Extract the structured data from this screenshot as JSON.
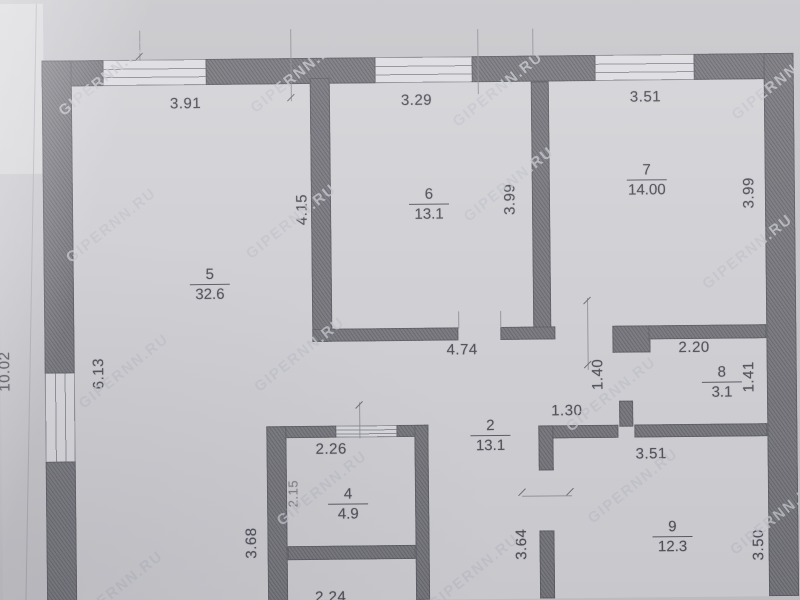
{
  "document": {
    "kind": "scanned floor plan (BTI style)"
  },
  "watermark": {
    "text": "GIPERNN.RU"
  },
  "rooms": {
    "r5": {
      "number": "5",
      "area": "32.6"
    },
    "r6": {
      "number": "6",
      "area": "13.1"
    },
    "r7": {
      "number": "7",
      "area": "14.00"
    },
    "r2": {
      "number": "2",
      "area": "13.1"
    },
    "r8": {
      "number": "8",
      "area": "3.1"
    },
    "r4": {
      "number": "4",
      "area": "4.9"
    },
    "r9": {
      "number": "9",
      "area": "12.3"
    }
  },
  "dims": {
    "room5_top": "3.91",
    "room6_top": "3.29",
    "room7_top": "3.51",
    "room6_left": "4.15",
    "room6_right": "3.99",
    "room7_right": "3.99",
    "left_wall": "6.13",
    "left_outer": "10.02",
    "hall_top": "4.74",
    "hall_pass": "1.30",
    "room8_top": "2.20",
    "room8_door": "1.40",
    "room8_right": "1.41",
    "room4_top": "2.26",
    "room4_left": "2.15",
    "room4_outer_left": "3.68",
    "room9_top": "3.51",
    "room9_left": "3.64",
    "room9_right": "3.50",
    "bottom_partial": "2.24"
  },
  "colors": {
    "paper": "#c7c7cb",
    "room_interior": "#d4d4d8",
    "wall": "#707076",
    "ink": "#4c4c56",
    "watermark": "#c6c6cf"
  }
}
